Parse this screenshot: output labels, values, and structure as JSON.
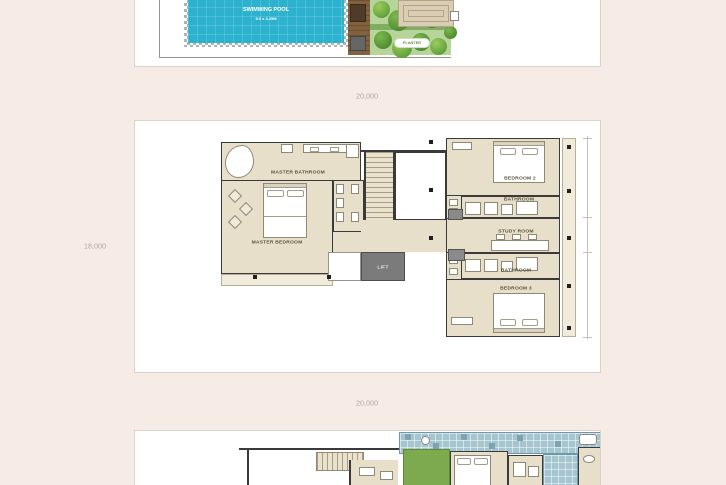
{
  "dims": {
    "top": "20,000",
    "left": "18,000",
    "bottom": "20,000"
  },
  "pool_level": {
    "pool_name": "SWIMMING POOL",
    "pool_size": "9.0 x 3.25M",
    "planter": "PLANTER"
  },
  "floor2": {
    "master_bathroom": "MASTER BATHROOM",
    "master_bedroom": "MASTER BEDROOM",
    "bedroom2": "BEDROOM 2",
    "bathroom_upper": "BATHROOM",
    "study": "STUDY ROOM",
    "bathroom_lower": "BATHROOM",
    "bedroom3": "BEDROOM 3",
    "lift": "LIFT"
  },
  "colors": {
    "background": "#f7ebe6",
    "pool_water": "#2cb2ce",
    "floor_beige": "#e7dfc9",
    "wall": "#3a3a3a",
    "lawn": "#7da94f",
    "terrace_tile": "#a5c6d1"
  }
}
